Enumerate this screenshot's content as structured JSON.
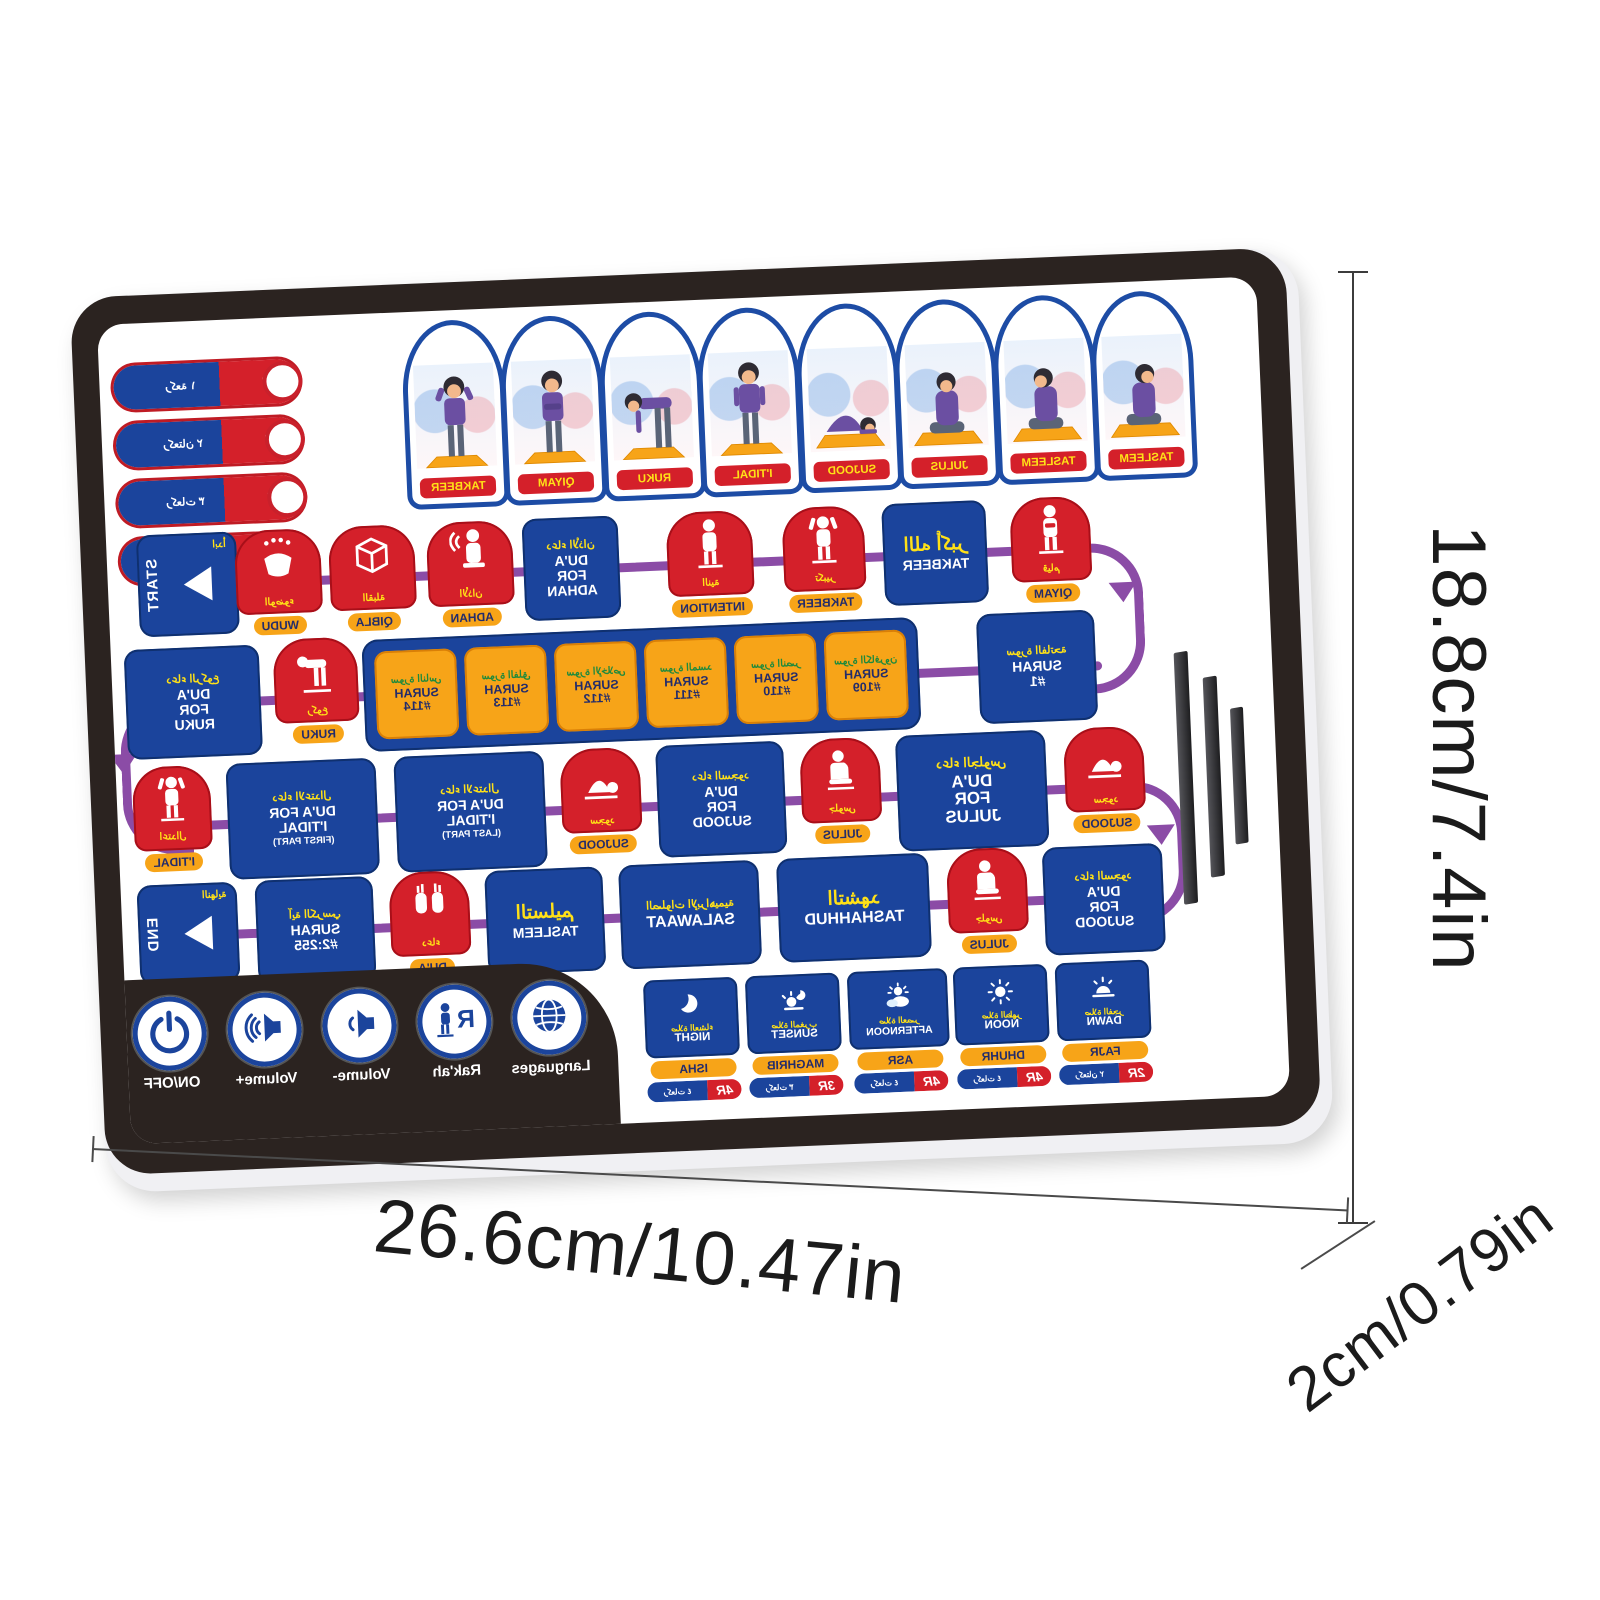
{
  "toggles": [
    {
      "rakah": "1R",
      "arabic": "ركعة ١"
    },
    {
      "rakah": "2R",
      "arabic": "ركعتان ٢"
    },
    {
      "rakah": "3R",
      "arabic": "ركعات ٣"
    },
    {
      "rakah": "4R",
      "arabic": "ركعات ٤"
    }
  ],
  "arches": [
    {
      "label": "TAKBEER"
    },
    {
      "label": "QIYAM"
    },
    {
      "label": "RUKU"
    },
    {
      "label": "I'TIDAL"
    },
    {
      "label": "SUJOOD"
    },
    {
      "label": "JULUS"
    },
    {
      "label": "TASLEEM"
    },
    {
      "label": "TASLEEM"
    }
  ],
  "row1": [
    {
      "label": "START",
      "arabic": "ابدأ"
    },
    {
      "label": "WUDU",
      "arabic": "الوضوء"
    },
    {
      "label": "QIBLA",
      "arabic": "القبلة"
    },
    {
      "label": "ADHAN",
      "arabic": "الأذان"
    },
    {
      "label": "DU'A FOR ADHAN",
      "arabic": "دعاء الأذان"
    },
    {
      "label": "INTENTION",
      "arabic": "النية"
    },
    {
      "label": "TAKBEER",
      "arabic": "تكبير"
    },
    {
      "label": "TAKBEER",
      "arabic": "الله أكبر"
    },
    {
      "label": "QIYAM",
      "arabic": "قيام"
    }
  ],
  "row2": [
    {
      "label": "DU'A FOR RUKU",
      "arabic": "دعاء الركوع"
    },
    {
      "label": "RUKU",
      "arabic": "ركوع"
    },
    {
      "label": "SURAH #114",
      "arabic": "سورة الناس"
    },
    {
      "label": "SURAH #113",
      "arabic": "سورة الفلق"
    },
    {
      "label": "SURAH #112",
      "arabic": "سورة الإخلاص"
    },
    {
      "label": "SURAH #111",
      "arabic": "سورة المسد"
    },
    {
      "label": "SURAH #110",
      "arabic": "سورة النصر"
    },
    {
      "label": "SURAH #109",
      "arabic": "سورة الكافرون"
    },
    {
      "label": "SURAH #1",
      "arabic": "سورة الفاتحة"
    }
  ],
  "row3": [
    {
      "label": "I'TIDAL",
      "arabic": "اعتدال"
    },
    {
      "label": "DU'A FOR I'TIDAL",
      "sub": "(FIRST PART)",
      "arabic": "دعاء الاعتدال"
    },
    {
      "label": "DU'A FOR I'TIDAL",
      "sub": "(LAST PART)",
      "arabic": "دعاء الاعتدال"
    },
    {
      "label": "SUJOOD",
      "arabic": "سجود"
    },
    {
      "label": "DU'A FOR SUJOOD",
      "arabic": "دعاء السجود"
    },
    {
      "label": "JULUS",
      "arabic": "جلوس"
    },
    {
      "label": "DU'A FOR JULUS",
      "arabic": "دعاء الجلوس"
    },
    {
      "label": "SUJOOD",
      "arabic": "سجود"
    }
  ],
  "row4": [
    {
      "label": "END",
      "arabic": "النهاية"
    },
    {
      "label": "SURAH #2:255",
      "arabic": "آية الكرسي"
    },
    {
      "label": "DU'A",
      "arabic": "دعاء"
    },
    {
      "label": "TASLEEM",
      "arabic": "التسليم"
    },
    {
      "label": "SALAWAAT",
      "arabic": "الصلوات الإبراهيمية"
    },
    {
      "label": "TASHAHHUD",
      "arabic": "التشهد"
    },
    {
      "label": "JULUS",
      "arabic": "جلوس"
    },
    {
      "label": "DU'A FOR SUJOOD",
      "arabic": "دعاء السجود"
    }
  ],
  "controls": [
    {
      "label": "ON/OFF"
    },
    {
      "label": "Volume+"
    },
    {
      "label": "Volume-"
    },
    {
      "label": "Rak'ah"
    },
    {
      "label": "Languages"
    }
  ],
  "prayers": [
    {
      "name": "NIGHT",
      "time": "ISHA",
      "rakah": "4R",
      "arabic": "صلاة العشاء",
      "rakah_arabic": "ركعات ٤"
    },
    {
      "name": "SUNSET",
      "time": "MAGHRIB",
      "rakah": "3R",
      "arabic": "صلاة المغرب",
      "rakah_arabic": "ركعات ٣"
    },
    {
      "name": "AFTERNOON",
      "time": "ASR",
      "rakah": "4R",
      "arabic": "صلاة العصر",
      "rakah_arabic": "ركعات ٤"
    },
    {
      "name": "NOON",
      "time": "DHUHR",
      "rakah": "4R",
      "arabic": "صلاة الظهر",
      "rakah_arabic": "ركعات ٤"
    },
    {
      "name": "DAWN",
      "time": "FAJR",
      "rakah": "2R",
      "arabic": "صلاة الفجر",
      "rakah_arabic": "ركعتان ٢"
    }
  ],
  "dimensions": {
    "width": "26.6cm/10.47in",
    "height": "18.8cm/7.4in",
    "depth": "2cm/0.79in"
  },
  "colors": {
    "blue": "#1b449c",
    "red": "#d4202a",
    "orange": "#f7a418",
    "yellow": "#ffe117",
    "purple": "#8b4ca6",
    "bezel": "#2b2320",
    "green_arabic": "#1f8a3c"
  }
}
